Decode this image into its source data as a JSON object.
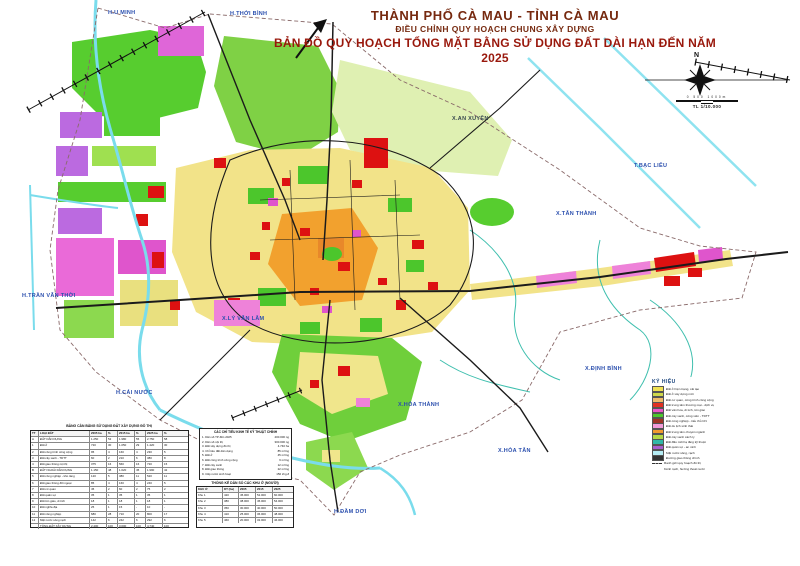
{
  "title": {
    "line1": "THÀNH PHỐ CÀ MAU - TỈNH CÀ MAU",
    "line2": "ĐIỀU CHỈNH QUY HOẠCH CHUNG XÂY DỰNG",
    "line3": "BẢN ĐỒ QUY HOẠCH TỔNG MẶT BẰNG SỬ DỤNG ĐẤT DÀI HẠN ĐẾN NĂM 2025"
  },
  "compass": {
    "north_label": "N"
  },
  "scale": {
    "bar_numbers": "0  500  1000m",
    "text": "TL 1/10.000"
  },
  "colors": {
    "title_brown": "#76290f",
    "title_red": "#99180c",
    "river": "#7adcec",
    "road": "#1b1b1b",
    "label_blue": "#2b4fae"
  },
  "map": {
    "labels": [
      {
        "text": "H.U MINH"
      },
      {
        "text": "H.THỚI BÌNH"
      },
      {
        "text": "T.BẠC LIÊU"
      },
      {
        "text": "H.TRẦN VĂN THỜI"
      },
      {
        "text": "H.CÁI NƯỚC"
      },
      {
        "text": "H.ĐẦM DƠI"
      },
      {
        "text": "X.AN XUYÊN"
      },
      {
        "text": "X.TÂN THÀNH"
      },
      {
        "text": "X.ĐỊNH BÌNH"
      },
      {
        "text": "X.HÒA TÂN"
      },
      {
        "text": "X.HÒA THÀNH"
      },
      {
        "text": "X.LÝ VĂN LÂM"
      }
    ]
  },
  "legend": {
    "title": "KÝ HIỆU",
    "items": [
      {
        "color": "#f0e152",
        "label": "Đất ở hiện trạng, cải tạo",
        "style": "solid"
      },
      {
        "color": "#cfd84b",
        "label": "Đất ở xây dựng mới",
        "style": "solid"
      },
      {
        "color": "#f0bc6a",
        "label": "Đất cơ quan, công trình công cộng",
        "style": "solid"
      },
      {
        "color": "#e03022",
        "label": "Đất trung tâm thương mại - dịch vụ",
        "style": "solid"
      },
      {
        "color": "#ee55cc",
        "label": "Đất văn hóa, di tích, tôn giáo",
        "style": "solid"
      },
      {
        "color": "#4cc92c",
        "label": "Đất cây xanh, công viên - TDTT",
        "style": "solid"
      },
      {
        "color": "#a03326",
        "label": "Đất công nghiệp - tiểu thủ CN",
        "style": "solid"
      },
      {
        "color": "#f29ad9",
        "label": "Đất du lịch sinh thái",
        "style": "solid"
      },
      {
        "color": "#f29a2e",
        "label": "Đất trung tâm chuyên ngành",
        "style": "solid"
      },
      {
        "color": "#b5d944",
        "label": "Đất cây xanh cách ly",
        "style": "solid"
      },
      {
        "color": "#2fb9a8",
        "label": "Đất đầu mối hạ tầng kỹ thuật",
        "style": "solid"
      },
      {
        "color": "#a85fd0",
        "label": "Đất quân sự - an ninh",
        "style": "solid"
      },
      {
        "color": "#b5ecf4",
        "label": "Mặt nước sông, rạch",
        "style": "solid"
      },
      {
        "color": "#333333",
        "label": "Đường giao thông chính",
        "style": "solid"
      },
      {
        "color": "#ffffff",
        "label": "Ranh giới quy hoạch đô thị",
        "style": "dashed"
      },
      {
        "color": "#ffffff",
        "label": "Kênh rạch, hướng thoát nước",
        "style": "wavy"
      }
    ]
  },
  "tables": {
    "t1": {
      "title": "BẢNG CÂN BẰNG SỬ DỤNG ĐẤT XÂY DỰNG ĐÔ THỊ",
      "headers": [
        "TT",
        "LOẠI ĐẤT",
        "2005 ha",
        "%",
        "2015 ha",
        "%",
        "2025 ha",
        "%"
      ],
      "rows": [
        [
          "A",
          "ĐẤT DÂN DỤNG",
          "1.250",
          "52",
          "1.980",
          "55",
          "2.750",
          "58"
        ],
        [
          "1",
          "Đất ở",
          "720",
          "30",
          "1.050",
          "29",
          "1.420",
          "30"
        ],
        [
          "2",
          "Đất công trình công cộng",
          "95",
          "4",
          "160",
          "4",
          "230",
          "5"
        ],
        [
          "3",
          "Đất cây xanh - TDTT",
          "60",
          "2",
          "210",
          "6",
          "380",
          "8"
        ],
        [
          "4",
          "Đất giao thông nội thị",
          "375",
          "16",
          "560",
          "16",
          "720",
          "15"
        ],
        [
          "B",
          "ĐẤT NGOÀI DÂN DỤNG",
          "1.150",
          "48",
          "1.620",
          "45",
          "1.990",
          "42"
        ],
        [
          "5",
          "Đất công nghiệp - kho tàng",
          "120",
          "5",
          "380",
          "11",
          "520",
          "11"
        ],
        [
          "6",
          "Đất giao thông đối ngoại",
          "85",
          "4",
          "160",
          "4",
          "240",
          "5"
        ],
        [
          "7",
          "Đất cơ quan",
          "45",
          "2",
          "60",
          "2",
          "75",
          "2"
        ],
        [
          "8",
          "Đất quân sự",
          "35",
          "1",
          "35",
          "1",
          "35",
          "1"
        ],
        [
          "9",
          "Đất tôn giáo, di tích",
          "18",
          "1",
          "18",
          "1",
          "18",
          "1"
        ],
        [
          "10",
          "Đất nghĩa địa",
          "25",
          "1",
          "15",
          "-",
          "10",
          "-"
        ],
        [
          "11",
          "Đất nông nghiệp",
          "680",
          "28",
          "710",
          "20",
          "800",
          "17"
        ],
        [
          "12",
          "Mặt nước sông rạch",
          "142",
          "6",
          "242",
          "6",
          "292",
          "6"
        ],
        [
          "",
          "TỔNG ĐẤT XÂY DỰNG",
          "2.400",
          "100",
          "3.600",
          "100",
          "4.740",
          "100"
        ]
      ]
    },
    "kpi": {
      "title": "CÁC CHỈ TIÊU KINH TẾ KỸ THUẬT CHÍNH",
      "items": [
        {
          "label": "1. Dân số TP đến 2025",
          "value": "400.000 ng"
        },
        {
          "label": "2. Dân số nội thị",
          "value": "300.000 ng"
        },
        {
          "label": "3. Đất xây dựng đô thị",
          "value": "4.740 ha"
        },
        {
          "label": "4. Chỉ tiêu đất dân dụng",
          "value": "85 m²/ng"
        },
        {
          "label": "5. Đất ở",
          "value": "45 m²/ng"
        },
        {
          "label": "6. Đất công trình công cộng",
          "value": "6 m²/ng"
        },
        {
          "label": "7. Đất cây xanh",
          "value": "12 m²/ng"
        },
        {
          "label": "8. Đất giao thông",
          "value": "22 m²/ng"
        },
        {
          "label": "9. Cấp nước sinh hoạt",
          "value": "150 l/ng.đ"
        }
      ]
    },
    "t2": {
      "title": "THỐNG KÊ DÂN SỐ CÁC KHU Ở (NGƯỜI)",
      "headers": [
        "KHU Ở",
        "DT (ha)",
        "2005",
        "2015",
        "2025"
      ],
      "rows": [
        [
          "Khu 1",
          "420",
          "45.000",
          "52.000",
          "60.000"
        ],
        [
          "Khu 2",
          "380",
          "38.000",
          "45.000",
          "54.000"
        ],
        [
          "Khu 3",
          "350",
          "30.000",
          "40.000",
          "50.000"
        ],
        [
          "Khu 4",
          "410",
          "25.000",
          "36.000",
          "48.000"
        ],
        [
          "Khu 5",
          "460",
          "20.000",
          "32.000",
          "46.000"
        ]
      ]
    }
  }
}
